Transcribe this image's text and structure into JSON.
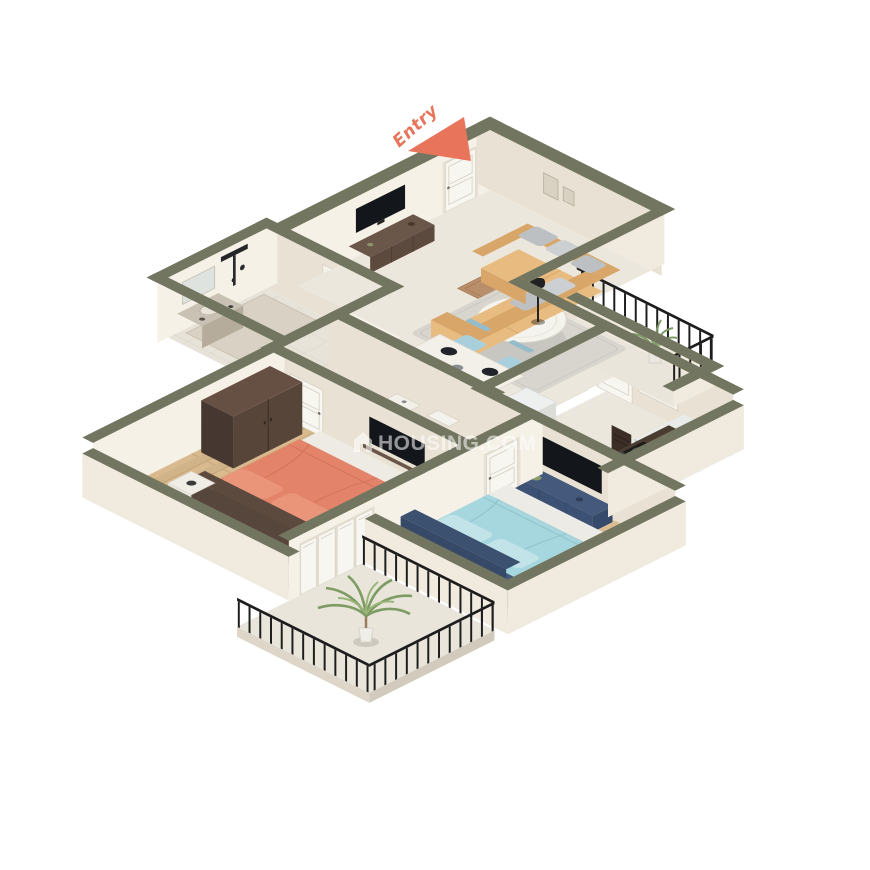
{
  "annotations": {
    "entry_label": "Entry"
  },
  "watermark": {
    "text": "HOUSING.COM",
    "icon": "house-icon"
  },
  "colors": {
    "bg": "#ffffff",
    "olive": "#72755f",
    "cream-light": "#f6f1e7",
    "cream-dark": "#e9e2d4",
    "cream-outer": "#f0eadf",
    "marble": "#ece7dd",
    "tile": "#e8e3d8",
    "balcony-floor": "#eae5da",
    "wood": "#d9ba8e",
    "wood-line": "#c3a276",
    "wood2": "#e0c297",
    "wood2-line": "#caa87e",
    "rug-light": "#d8d5cf",
    "rug-gray": "#a9a59f",
    "sofa": "#e8bc80",
    "sofa-dark": "#d8a668",
    "pillow-gray": "#bdc0c2",
    "coral": "#e2836a",
    "coral-deep": "#ea947a",
    "navy": "#44597c",
    "navy-dark": "#3c506f",
    "sky": "#a6d7de",
    "sky-light": "#c2e4e8",
    "chair-blue": "#a9cfdc",
    "cab-blue": "#a7cfdb",
    "brown-wood": "#5d4a3e",
    "wardrobe": "#57453a",
    "counter": "#4a3c31",
    "stove": "#1c1c1c",
    "fridge": "#eef0ef",
    "door-white": "#f8f6f1",
    "door-frame": "#e8e1d4",
    "door-line": "#d8d2c6",
    "tv": "#13161a",
    "rail": "#1d1d1d",
    "plant": "#7d9c63",
    "plant-light": "#9ab579",
    "pot": "#e9e7e0",
    "entry": "#e8745c"
  },
  "scene": {
    "rooms": [
      {
        "name": "living-dining-room",
        "furniture": [
          "entry-door",
          "doormat",
          "wall-tv",
          "tv-console",
          "wall-frames",
          "l-shaped-sofa",
          "throw-pillows",
          "area-rug",
          "coffee-table",
          "floor-lamp",
          "dining-table",
          "dining-chairs",
          "tableware"
        ]
      },
      {
        "name": "kitchen",
        "furniture": [
          "refrigerator",
          "counter-with-stove",
          "cooking-pans",
          "chimney-hood",
          "blue-cabinets",
          "kitchen-door",
          "kitchen-window"
        ]
      },
      {
        "name": "bathroom-1",
        "furniture": [
          "rain-shower",
          "shower-tray",
          "vanity-counter",
          "mirror",
          "window-blinds"
        ]
      },
      {
        "name": "bathroom-2",
        "furniture": [
          "toilet",
          "washbasin",
          "shower-area"
        ]
      },
      {
        "name": "bedroom-1",
        "furniture": [
          "wardrobe",
          "double-bed-coral",
          "pillows",
          "nightstands",
          "table-lamps",
          "wall-tv",
          "shelf",
          "room-door",
          "folding-balcony-doors"
        ]
      },
      {
        "name": "bedroom-2",
        "furniture": [
          "double-bed-blue",
          "pillows",
          "media-console",
          "wall-tv",
          "nightstand",
          "room-door",
          "gray-rug"
        ]
      },
      {
        "name": "balcony-kitchen-side",
        "furniture": [
          "iron-railing",
          "potted-plant"
        ]
      },
      {
        "name": "balcony-bedroom-side",
        "furniture": [
          "iron-railing",
          "palm-plant"
        ]
      }
    ]
  }
}
